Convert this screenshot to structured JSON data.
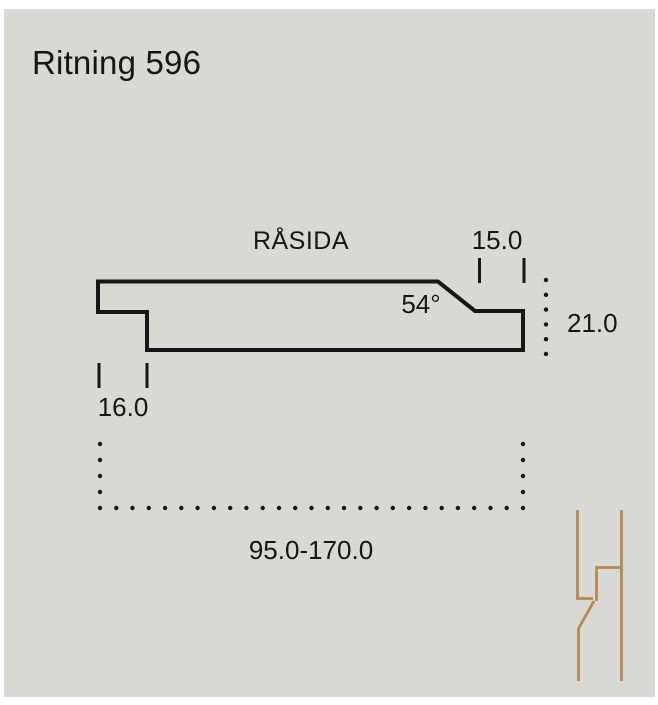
{
  "title": "Ritning 596",
  "drawing": {
    "surface_label": "RÅSIDA",
    "dimensions": {
      "bevel_angle": "54°",
      "tongue_width": "15.0",
      "thickness": "21.0",
      "notch_width": "16.0",
      "total_width_range": "95.0-170.0"
    }
  },
  "icons": {
    "joint_icon": "cladding-joint-profile-icon"
  },
  "colors": {
    "panel_background": "#d8d9d4",
    "line_color": "#161616",
    "wood_icon_color": "#b8894c"
  }
}
